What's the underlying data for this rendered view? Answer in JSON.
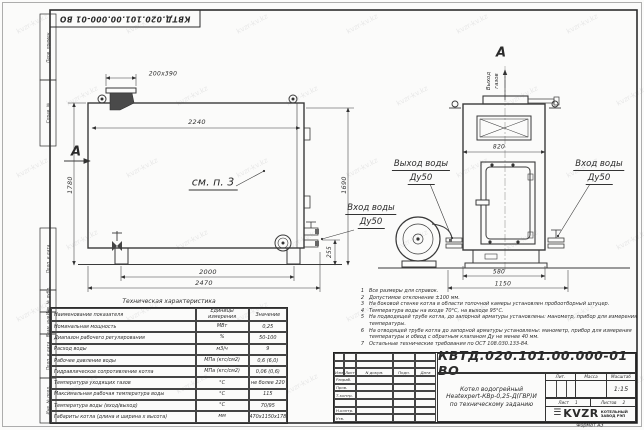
{
  "sheet": {
    "stamp_top": "КВТД.020.101.00.000-01 ВО",
    "format_label": "Формат",
    "format_value": "А3",
    "frame_columns": [
      "Перв. примен.",
      "Справ. №",
      "Подп. и дата",
      "Инв. № дубл.",
      "Взам. инв. №",
      "Подп. и дата",
      "Инв. № подл."
    ]
  },
  "watermark": {
    "text": "kvzr-kv.kz"
  },
  "views": {
    "side_view": {
      "section_mark": "А",
      "callout": "см. п. 3",
      "dims": {
        "top_duct": "200х390",
        "inner_width": "2240",
        "height_left": "1780",
        "height_right": "1690",
        "bottom_width": "2000",
        "overall_width": "2470",
        "right_offset": "255"
      },
      "label_water_inlet": [
        "Вход воды",
        "Ду50"
      ]
    },
    "front_view": {
      "view_mark": "А",
      "flue_label": [
        "Выход",
        "газов"
      ],
      "dims": {
        "width": "820",
        "base_width": "580",
        "overall_width": "1150"
      },
      "label_water_outlet": [
        "Выход воды",
        "Ду50"
      ],
      "label_water_inlet": [
        "Вход воды",
        "Ду50"
      ]
    }
  },
  "notes": [
    "Все размеры для справок.",
    "Допустимое отклонение ±100 мм.",
    "На боковой стенке котла в области топочной камеры установлен пробоотборный штуцер.",
    "Температура воды на входе 70°С, на выходе 95°С.",
    "На подводящей трубе котла, до запорной арматуры установлены: манометр, прибор для измерения температуры.",
    "На отводящей трубе котла до запорной арматуры установлены: манометр, прибор для измерения температуры и обвод с обратным клапаном Ду не менее 40 мм.",
    "Остальные технические требования по ОСТ 108.030.133-84."
  ],
  "tech_table": {
    "title": "Техническая характеристика",
    "headers": [
      "Наименование показателя",
      "Единицы измерения",
      "Значение"
    ],
    "rows": [
      [
        "Номинальная мощность",
        "МВт",
        "0,25"
      ],
      [
        "Диапазон рабочего регулирования",
        "%",
        "50-100"
      ],
      [
        "Расход воды",
        "м3/ч",
        "9"
      ],
      [
        "Рабочее давление воды",
        "МПа (кгс/см2)",
        "0,6 (6,0)"
      ],
      [
        "Гидравлическое сопротивление котла",
        "МПа (кгс/см2)",
        "0,06 (0,6)"
      ],
      [
        "Температура уходящих газов",
        "°С",
        "не более 220"
      ],
      [
        "Максимальная рабочая температура воды",
        "°С",
        "115"
      ],
      [
        "Температура воды (вход/выход)",
        "°С",
        "70/95"
      ],
      [
        "Габариты котла (длина и ширина х высота)",
        "мм",
        "2470х1150х1780"
      ]
    ]
  },
  "title_block": {
    "doc_number": "КВТД.020.101.00.000-01 ВО",
    "product_name": [
      "Котел водогрейный",
      "Heatexpert-КВр-0,25-Д(ГВР)И",
      "по техническому заданию"
    ],
    "header_row": [
      "Изм",
      "Лист",
      "N докум.",
      "Подп.",
      "Дата"
    ],
    "role_rows": [
      "Разраб.",
      "Пров.",
      "Т.контр.",
      "",
      "Н.контр.",
      "Утв."
    ],
    "lit_label": "Лит.",
    "mass_label": "Масса",
    "scale_label": "Масштаб",
    "scale_value": "1:15",
    "sheet_label": "Лист",
    "sheet_value": "1",
    "sheets_label": "Листов",
    "sheets_value": "2",
    "company_logo": "KVZR",
    "company_name": [
      "КОТЕЛЬНЫЙ",
      "ЗАВОД РЭП"
    ]
  }
}
